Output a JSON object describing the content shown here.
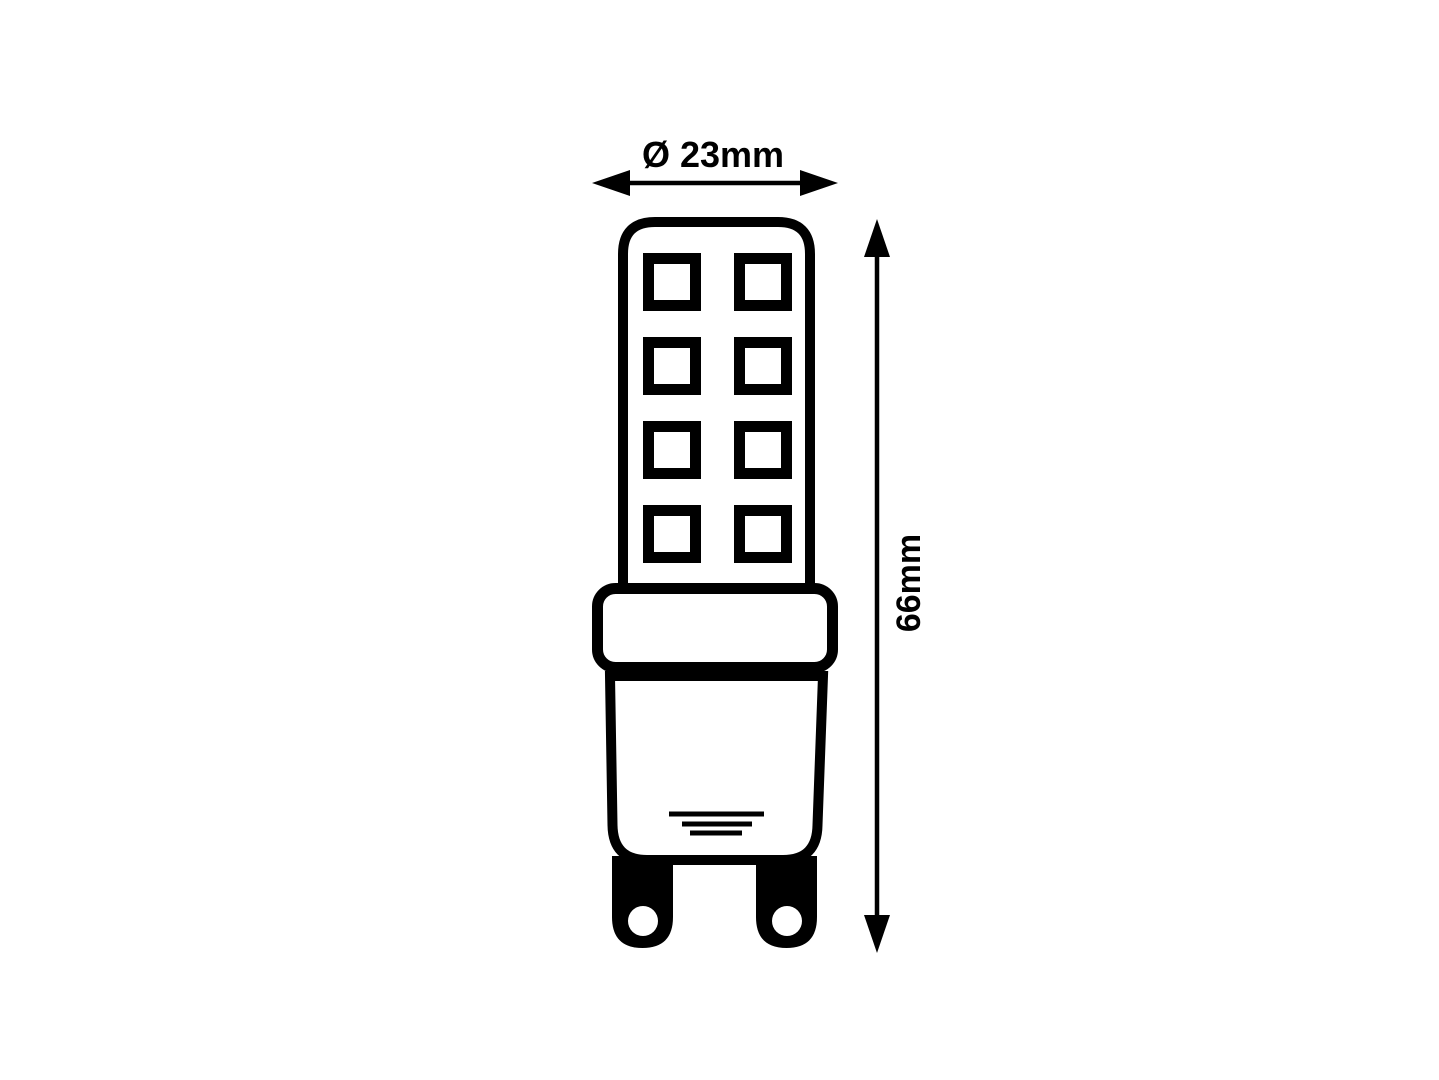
{
  "page": {
    "background_color": "#ffffff"
  },
  "diagram": {
    "subject": "G9 LED capsule bulb technical dimension drawing",
    "ink_color": "#000000",
    "paper_color": "#ffffff",
    "dimensions": {
      "diameter": {
        "label": "Ø 23mm",
        "value_mm": 23,
        "orientation": "horizontal"
      },
      "height": {
        "label": "66mm",
        "value_mm": 66,
        "orientation": "vertical"
      }
    },
    "bulb": {
      "led_chip_rows": 4,
      "led_chip_columns": 2,
      "led_chip_count": 8,
      "pin_count": 2,
      "base_hatch_line_count": 3
    }
  }
}
